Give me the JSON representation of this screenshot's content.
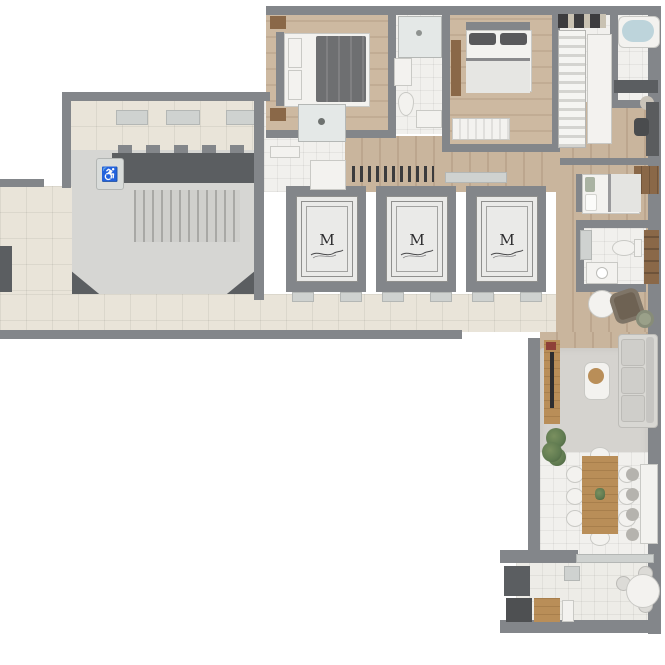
{
  "floor_plan": {
    "elevators": {
      "cabins": [
        {
          "label": "M"
        },
        {
          "label": "M"
        },
        {
          "label": "M"
        }
      ]
    },
    "stairwell": {
      "accessibility_icon": "♿"
    },
    "colors": {
      "wall": "#83868a",
      "wall_dark": "#5b5e61",
      "tile_floor": "#e9e4d9",
      "wood_floor": "#c9b59d",
      "bath_floor": "#f1f0ed",
      "stair_floor": "#d6d6d3",
      "rug": "#d5d3cf",
      "sofa": "#d8d7d3",
      "wood_furniture": "#b98e58",
      "dark_wood": "#8a6848",
      "plant": "#5f7a50",
      "elevator_door": "#eaeae8",
      "water": "#bdd4db",
      "balcony_floor": "#edece7",
      "accent_red": "#8e4038"
    }
  }
}
